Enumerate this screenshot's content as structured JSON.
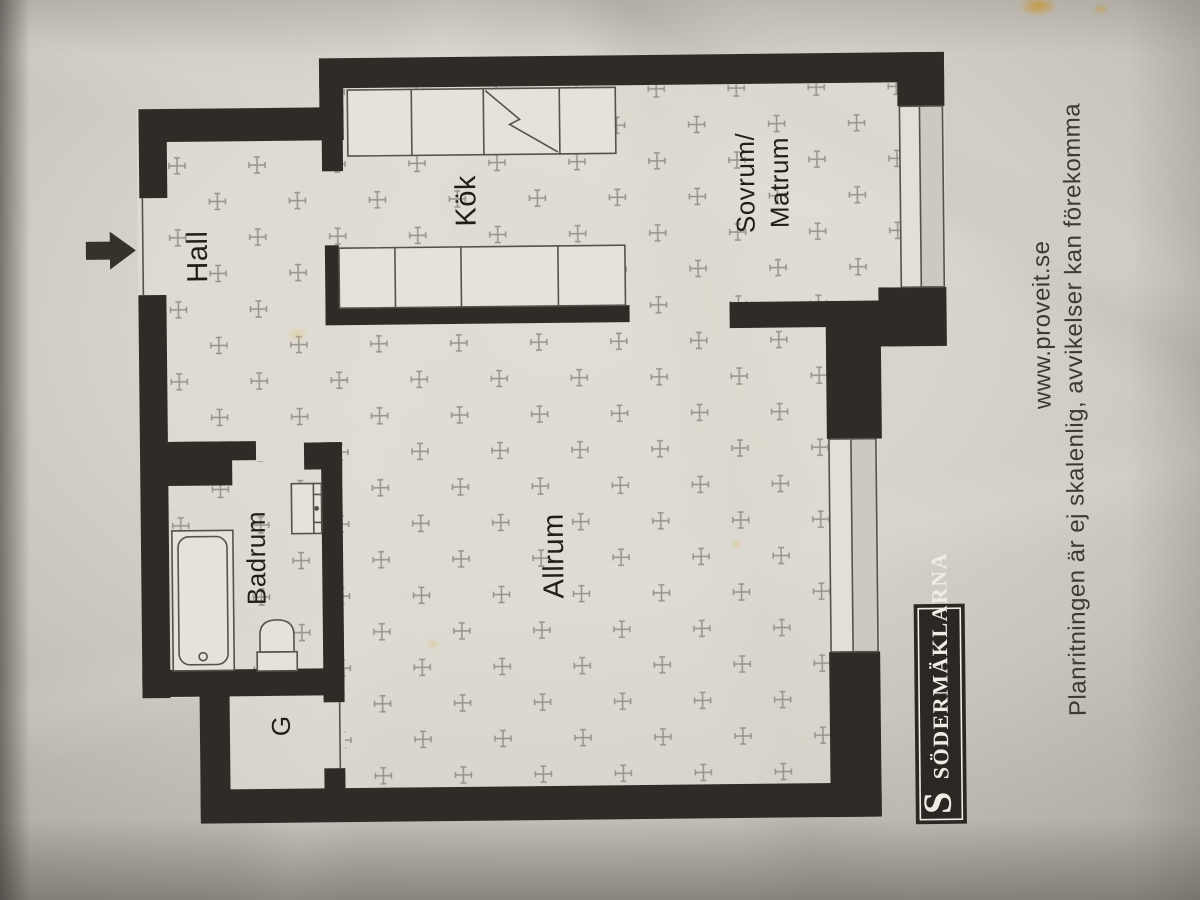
{
  "rooms": {
    "hall": "Hall",
    "kitchen": "Kök",
    "bedroom_line1": "Sovrum/",
    "bedroom_line2": "Matrum",
    "living": "Allrum",
    "bathroom": "Badrum",
    "closet": "G"
  },
  "annotations": {
    "website": "www.proveit.se",
    "disclaimer": "Planritningen är ej skalenlig, avvikelser kan förekomma"
  },
  "brand": {
    "initial": "S",
    "name": "SÖDERMÄKLARNA"
  },
  "colors": {
    "wall": "#2f2b26",
    "paper": "#d9d5cd",
    "floor_pattern": "#97928a",
    "ink": "#201e1a",
    "stain": "#dd9f25"
  }
}
